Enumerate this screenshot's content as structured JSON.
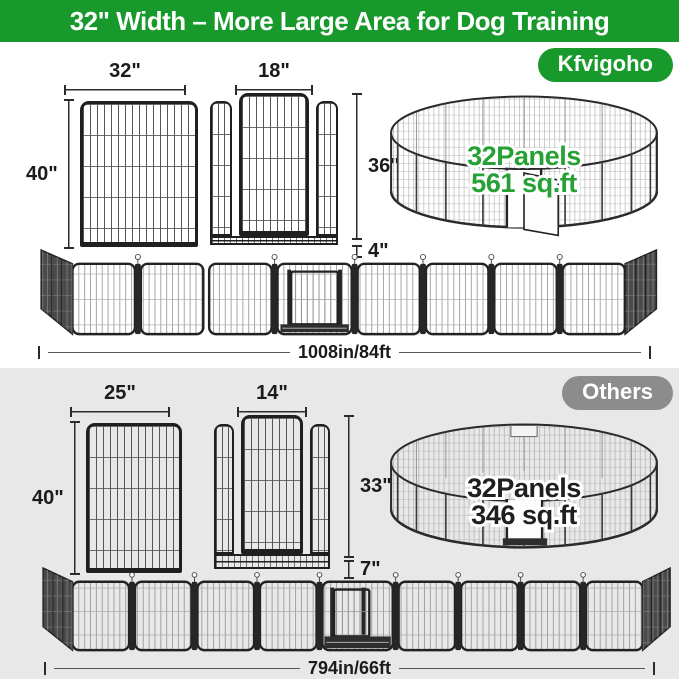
{
  "banner": {
    "title": "32\" Width – More Large Area for Dog Training"
  },
  "sections": {
    "kfvigoho": {
      "badge_label": "Kfvigoho",
      "panel_width": "32\"",
      "panel_height": "40\"",
      "door_width": "18\"",
      "door_height": "36\"",
      "door_bottom": "4\"",
      "pen_line1": "32Panels",
      "pen_line2": "561 sq.ft",
      "fence_length": "1008in/84ft"
    },
    "others": {
      "badge_label": "Others",
      "panel_width": "25\"",
      "panel_height": "40\"",
      "door_width": "14\"",
      "door_height": "33\"",
      "door_bottom": "7\"",
      "pen_line1": "32Panels",
      "pen_line2": "346 sq.ft",
      "fence_length": "794in/66ft"
    }
  },
  "colors": {
    "brand_green": "#17992c",
    "others_gray": "#8c8c8c",
    "pen_text_green": "#27a135",
    "pen_text_dark": "#1f1f1f",
    "section_bg_gray": "#e8e8e8"
  }
}
